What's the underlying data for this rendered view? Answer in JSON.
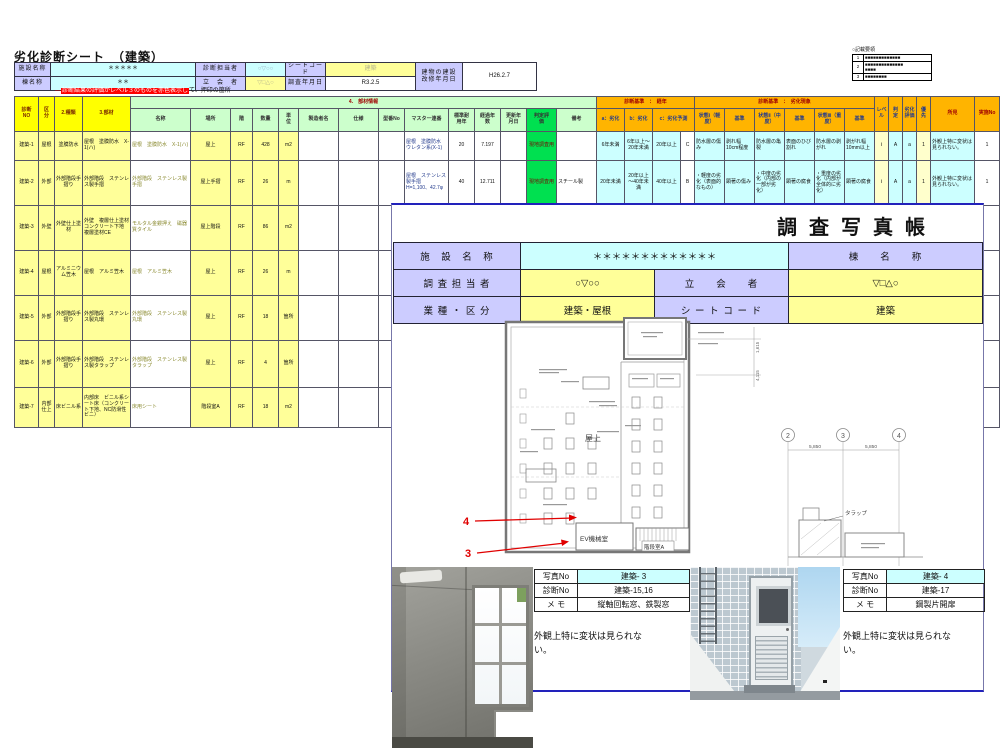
{
  "sheet1": {
    "title": "劣化診断シート　（建築）",
    "info": {
      "labels": {
        "facility": "施設名称",
        "building": "棟名称",
        "surveyor": "診断担当者",
        "witness": "立　会　者",
        "sheet_code": "シートコード",
        "survey_date": "調査年月日",
        "built_date": "建物の建設\n改修年月日"
      },
      "values": {
        "facility": "＊＊＊＊＊",
        "building": "＊＊",
        "surveyor": "○▽○○",
        "witness": "▽□△○",
        "sheet_code": "建築",
        "survey_date": "R3.2.5",
        "built_date": "H26.2.7"
      }
    },
    "note": {
      "dash": "―",
      "red": "診断結果の評価がレベル３のものを赤色表示し",
      "black": "て、押印の箇所"
    },
    "legend": {
      "title": "○記載要領",
      "rows": [
        {
          "no": "1",
          "text": "■■■■■■■■■■■■■"
        },
        {
          "no": "2",
          "text": "■■■■■■■■■■■■■■\n■■■■"
        },
        {
          "no": "3",
          "text": "■■■■■■■■"
        }
      ]
    },
    "table": {
      "h1": [
        "診断\nNO",
        "区\n分",
        "2.種類",
        "3.部材",
        "4.　部材情報",
        "診断基準　：　経年",
        "診断基準　：　劣化現象",
        "レベ\nル",
        "判\n定",
        "劣化\n評価",
        "優\n先",
        "所見",
        "実施No"
      ],
      "h2": [
        "名称",
        "場所",
        "階",
        "数量",
        "単\n位",
        "製造者名",
        "仕様",
        "型番No",
        "マスター連番",
        "標準耐\n用年",
        "経過年\n数",
        "更新年\n月日",
        "判定評\n価",
        "備考",
        "a：劣化",
        "b：劣化",
        "c：劣化予測",
        "状態Ⅰ（軽\n度）",
        "基準",
        "状態Ⅱ（中\n度）",
        "基準",
        "状態Ⅲ（重\n度）",
        "基準"
      ],
      "rows": [
        [
          "建築-1",
          "屋根",
          "塗膜防水",
          "屋根　塗膜防水　X-1(ハ)",
          "屋根　塗膜防水　X-1(ハ)",
          "屋上",
          "RF",
          "428",
          "m2",
          "",
          "",
          "",
          "屋根　塗膜防水　ウレタン系(X-1)",
          "20",
          "7.197",
          "",
          "現地調査用",
          "",
          "6年未満",
          "6年以上～20年未満",
          "20年以上",
          "C",
          "防水層の傷み",
          "剥れ幅10cm程度",
          "防水層の亀裂",
          "表面のひび割れ",
          "防水層の剥がれ",
          "剥がれ幅10mm以上",
          "Ⅰ",
          "A",
          "a",
          "1",
          "外観上特に変状は見られない。",
          "1"
        ],
        [
          "建築-2",
          "外部",
          "外部階段手摺り",
          "外部階段　ステンレス製手摺",
          "外部階段　ステンレス製手摺",
          "屋上手摺",
          "RF",
          "26",
          "m",
          "",
          "",
          "",
          "屋根　ステンレス製手摺　H=1,100、42.7φ",
          "40",
          "12.711",
          "",
          "現地調査用",
          "スチール製",
          "20年未満",
          "20年以上～40年未満",
          "40年以上",
          "B",
          "・軽度の劣化（表面的なもの）",
          "顕著の傷み",
          "・中度の劣化（内部の一部が劣化）",
          "顕著の腐食",
          "・重度の劣化（内部が全体的に劣化）",
          "顕著の腐食",
          "Ⅰ",
          "A",
          "a",
          "1",
          "外観上特に変状は見られない。",
          "1"
        ],
        [
          "建築-3",
          "外壁",
          "外壁仕上塗材",
          "外壁　複層仕上塗材　コンクリート下地　複層塗材CE",
          "モルタル金鏝押え　磁器質タイル",
          "屋上階段",
          "RF",
          "86",
          "m2",
          "",
          "",
          "",
          "外壁　複層仕上塗材（コンクリート下地　複層塗材）",
          "",
          "",
          "",
          "",
          "",
          "",
          "",
          "",
          "",
          "",
          "",
          "",
          "",
          "",
          "",
          "",
          "",
          "",
          "",
          "",
          ""
        ],
        [
          "建築-4",
          "屋根",
          "アルミニウム笠木",
          "屋根　アルミ笠木",
          "屋根　アルミ笠木",
          "屋上",
          "RF",
          "26",
          "m",
          "",
          "",
          "",
          "屋根　下り笠木　t=1.0　幅3",
          "",
          "",
          "",
          "",
          "",
          "",
          "",
          "",
          "",
          "",
          "",
          "",
          "",
          "",
          "",
          "",
          "",
          "",
          "",
          "",
          ""
        ],
        [
          "建築-5",
          "外部",
          "外部階段手摺り",
          "外部階段　ステンレス製丸環",
          "外部階段　ステンレス製丸環",
          "屋上",
          "RF",
          "18",
          "箇所",
          "",
          "",
          "",
          "屋根　ステンレス製丸環　19、内150",
          "",
          "",
          "",
          "",
          "",
          "",
          "",
          "",
          "",
          "",
          "",
          "",
          "",
          "",
          "",
          "",
          "",
          "",
          "",
          "",
          ""
        ],
        [
          "建築-6",
          "外部",
          "外部階段手摺り",
          "外部階段　ステンレス製タラップ",
          "外部階段　ステンレス製タラップ",
          "屋上",
          "RF",
          "4",
          "箇所",
          "",
          "",
          "",
          "屋根　ステンレス製タラップ　25、W=400",
          "",
          "",
          "",
          "",
          "",
          "",
          "",
          "",
          "",
          "",
          "",
          "",
          "",
          "",
          "",
          "",
          "",
          "",
          "",
          "",
          ""
        ],
        [
          "建築-7",
          "内部仕上",
          "床ビニル系",
          "内部床　ビニル系シート床（コンクリート下地、NC防滑性ビニ）",
          "床用シート",
          "階段室A",
          "RF",
          "18",
          "m2",
          "",
          "",
          "",
          "内部床　ビニル系シート（コンクリート下地、N種）",
          "",
          "",
          "",
          "",
          "",
          "",
          "",
          "",
          "",
          "",
          "",
          "",
          "",
          "",
          "",
          "",
          "",
          "",
          "",
          "",
          ""
        ]
      ]
    }
  },
  "sheet2": {
    "title": "調査写真帳",
    "header": {
      "facility_label": "施　設　名　称",
      "facility_value": "＊＊＊＊＊＊＊＊＊＊＊＊＊",
      "building_label": "棟　　名　　称",
      "surveyor_label": "調 査 担 当 者",
      "surveyor_value": "○▽○○",
      "witness_label": "立　　会　　者",
      "witness_value": "▽□△○",
      "category_label": "業 種 ・ 区 分",
      "category_value": "建築・屋根",
      "sheetcode_label": "シ ー ト コ ー ド",
      "sheetcode_value": "建築"
    },
    "plan": {
      "rooftop": "屋上",
      "ev_room": "EV機械室",
      "stair_room": "階段室A",
      "marker4": "4",
      "marker3": "3",
      "grid": [
        "2",
        "3",
        "4"
      ],
      "dim1": "5,850",
      "dim2": "5,850",
      "tarappu": "タラップ",
      "vdim1": "1,615",
      "vdim2": "4,115"
    },
    "photos": [
      {
        "photo_no_label": "写真No",
        "photo_no": "建築- 3",
        "diag_no_label": "診断No",
        "diag_no": "建築-15,16",
        "memo_label": "メ モ",
        "memo": "縦軸回転窓、鉄製窓",
        "comment": "外観上特に変状は見られない。"
      },
      {
        "photo_no_label": "写真No",
        "photo_no": "建築- 4",
        "diag_no_label": "診断No",
        "diag_no": "建築-17",
        "memo_label": "メ モ",
        "memo": "鋼製片開扉",
        "comment": "外観上特に変状は見られない。"
      }
    ]
  },
  "colors": {
    "lavender": "#ccccff",
    "cyan": "#ccffff",
    "yellow": "#ffff99",
    "green": "#00e050",
    "orange": "#ffb400",
    "red_marker": "#e00000"
  }
}
